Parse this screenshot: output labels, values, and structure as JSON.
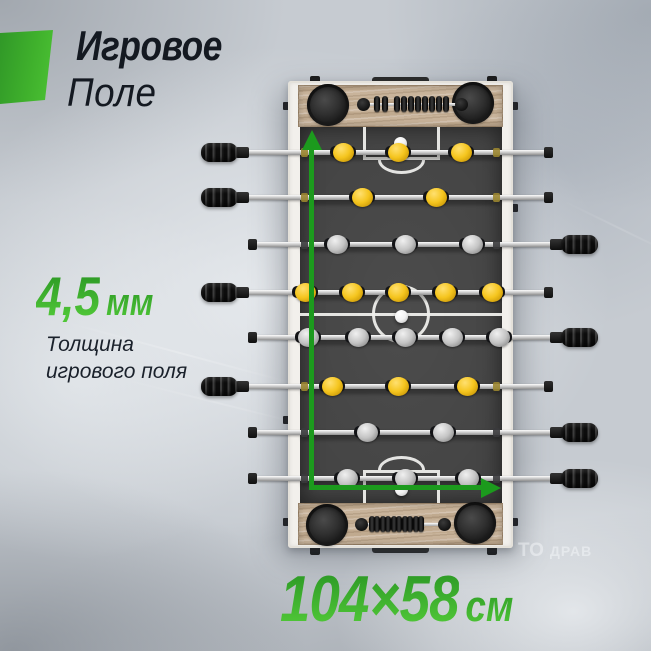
{
  "header": {
    "title_line1": "Игровое",
    "title_line2": "Поле"
  },
  "thickness": {
    "value": "4,5",
    "unit": "мм",
    "caption_line1": "Толщина",
    "caption_line2": "игрового поля"
  },
  "dimensions": {
    "value": "104×58",
    "unit": "см"
  },
  "watermark": {
    "fragment1": "ТО",
    "fragment2": "ДРАВ"
  },
  "colors": {
    "accent_green_dark": "#2e9b26",
    "accent_green_light": "#4fc637",
    "arrow_green": "#1c9a1d",
    "title_color": "#141921",
    "wood": "#c9b49b",
    "field": "#414141",
    "frame": "#f2f0ec",
    "team_yellow": "#f5c51e",
    "team_gray": "#c4c4c4"
  },
  "table": {
    "rods": [
      {
        "name": "rod-1-goalie-yellow",
        "y": 152,
        "handle": "left",
        "team": "yellow",
        "players": [
          343,
          398,
          461
        ]
      },
      {
        "name": "rod-2-defense-yellow",
        "y": 197,
        "handle": "left",
        "team": "yellow",
        "players": [
          362,
          436
        ]
      },
      {
        "name": "rod-3-attack-gray",
        "y": 244,
        "handle": "right",
        "team": "gray",
        "players": [
          337,
          405,
          472
        ]
      },
      {
        "name": "rod-4-midfield-yellow",
        "y": 292,
        "handle": "left",
        "team": "yellow",
        "players": [
          305,
          352,
          398,
          445,
          492
        ]
      },
      {
        "name": "rod-5-midfield-gray",
        "y": 337,
        "handle": "right",
        "team": "gray",
        "players": [
          308,
          358,
          405,
          452,
          499
        ]
      },
      {
        "name": "rod-6-attack-yellow",
        "y": 386,
        "handle": "left",
        "team": "yellow",
        "players": [
          332,
          398,
          467
        ]
      },
      {
        "name": "rod-7-defense-gray",
        "y": 432,
        "handle": "right",
        "team": "gray",
        "players": [
          367,
          443
        ]
      },
      {
        "name": "rod-8-goalie-gray",
        "y": 478,
        "handle": "right",
        "team": "gray",
        "players": [
          347,
          405,
          468
        ]
      }
    ],
    "score_counters": {
      "top": {
        "y": 104,
        "rod_x": [
          358,
          466
        ],
        "knobs": [
          363,
          461
        ],
        "beads": [
          377,
          385,
          397,
          404,
          411,
          418,
          425,
          432,
          439,
          446
        ]
      },
      "bottom": {
        "y": 524,
        "rod_x": [
          355,
          450
        ],
        "knobs": [
          361,
          444
        ],
        "beads": [
          372,
          377,
          383,
          388,
          394,
          399,
          405,
          410,
          416,
          421
        ]
      }
    },
    "balls": [
      {
        "x": 400,
        "y": 143
      },
      {
        "x": 401,
        "y": 316
      },
      {
        "x": 401,
        "y": 489
      }
    ]
  }
}
